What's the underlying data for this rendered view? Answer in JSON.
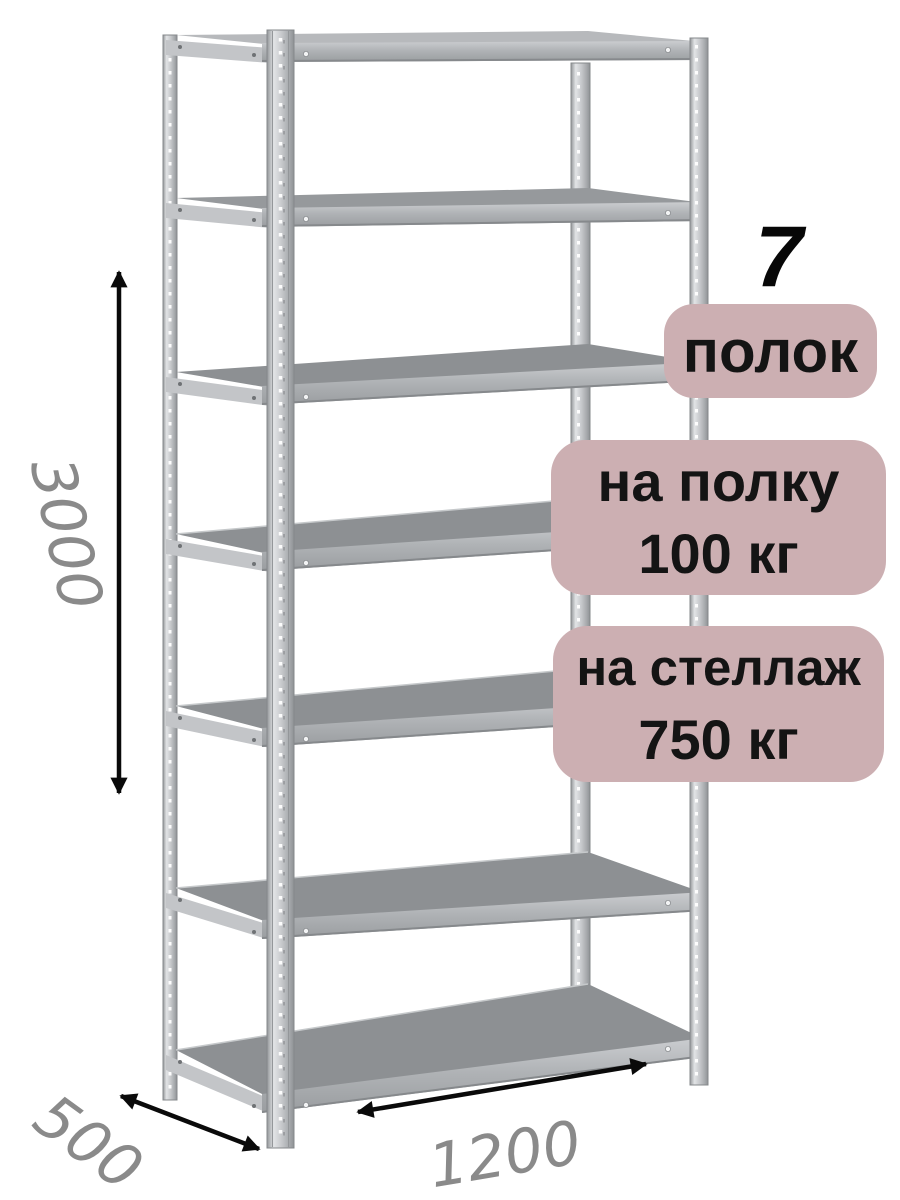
{
  "badges": {
    "count_number": "7",
    "count_label": "полок",
    "shelf_load_line1": "на полку",
    "shelf_load_line2": "100 кг",
    "rack_load_line1": "на стеллаж",
    "rack_load_line2": "750 кг"
  },
  "dimensions": {
    "height_label": "3000",
    "depth_label": "500",
    "width_label": "1200"
  },
  "illustration": {
    "shelf_count": 7,
    "post_count": 4,
    "description": "gray metal boltless shelving rack with perforated posts"
  },
  "colors": {
    "background": "#ffffff",
    "badge_pink": "#ccafb2",
    "badge_text": "#141414",
    "big_number_text": "#070707",
    "dimension_text": "#8a8a8a",
    "arrow_black": "#0a0a0a",
    "metal_highlight": "#e2e4e6",
    "metal_mid": "#b0b3b6",
    "metal_shelf_dark": "#8d9093"
  }
}
